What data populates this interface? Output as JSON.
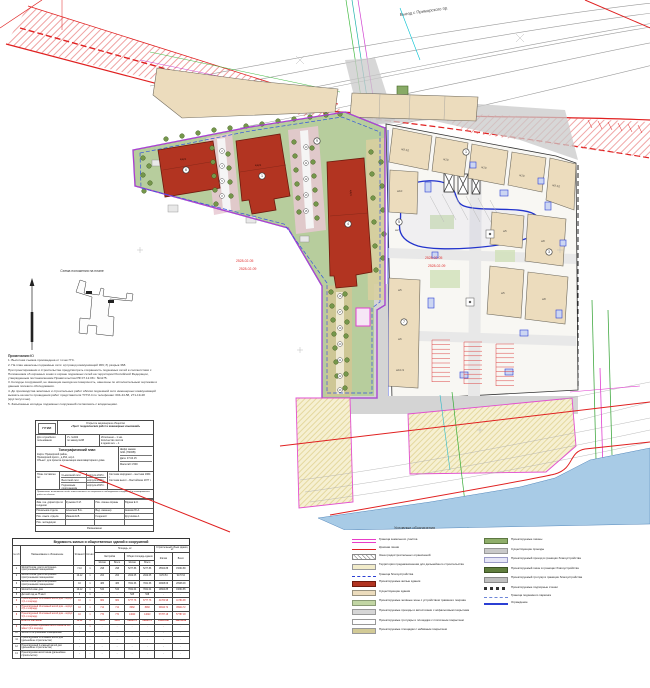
{
  "map": {
    "street_label": "Выезд с Приморского пр.",
    "date1": "2528-02-05",
    "date2": "2528-02-09",
    "lb_a": "жд21",
    "lb_b": "жд21",
    "lb_c": "жд21",
    "rb": [
      "ж9-10",
      "ж10",
      "ж10",
      "ж10",
      "ж9-10",
      "ж10",
      "ж2",
      "ж5",
      "ж8",
      "ж5",
      "ж8",
      "ж5",
      "ж6",
      "ж10-9"
    ],
    "big_circles": [
      "6",
      "1",
      "9",
      "4",
      "1",
      "5",
      "3",
      "7"
    ],
    "spine": [
      "2",
      "3",
      "5",
      "8",
      "10",
      "11",
      "12",
      "13",
      "15",
      "16",
      "17",
      "19",
      "20",
      "21",
      "22",
      "23"
    ],
    "scheme_caption": "Схема положения на плане",
    "north_label": "Ю"
  },
  "notes": {
    "title": "Примечания:",
    "items": [
      "1. Высотная съемка произведена от точек ГГС.",
      "2. На план нанесены подземные сети:  а) провод коммуникаций 369;  б) разрыв 368.",
      "При проектировании и строительстве предусмотреть сохранность подземных сетей в соответствии с Положением об охранных зонах и охране подземных сетей на территории Российской Федерации, утвержденным постановлением Правительства РФ 07.12.08 г. №1175.",
      "3. Колодцы сооружений, не имеющие выхода на поверхность, нанесены по исполнительным чертежам и данным полевого обследования.",
      "4. До производства земляных и строительных работ вблизи подземной сети инженерных коммуникаций вызвать на место проведения работ представителя ТУГИ-4 по телефонам: 004-44-58, 271-19-48 (круглосуточно).",
      "5. Засыпанные колодцы подземных сооружений согласовать с владельцами."
    ]
  },
  "titleblock": {
    "logo": "ГРИИ",
    "org_type": "Открытое акционерное общество",
    "org_name": "«Трест геодезических работ и инженерных изысканий»",
    "dsp": "Для служебного пользования",
    "order_no": "Уч. №402",
    "order_sub": "по заказу №88",
    "copies1": "Исполнено – 1 экз.",
    "copies2": "Количество листов",
    "copies3": "в одном экз. – 1",
    "doc_type": "Топографический план",
    "map_line1": "Карта: Приморский район,",
    "map_line2": "Приморский просп., д.454, кор.1",
    "object_line": "Объект: для проекта организации многоквартирного дома",
    "cipher_label": "Шифр заказа:",
    "cipher": "№91 (Н200В)",
    "date": "Дата: 07.04.15",
    "scale": "Масштаб 1:500",
    "composed_label": "План составлен по:",
    "composed_rows": [
      [
        "Съемочной сети",
        "корпуса 2015 г."
      ],
      [
        "Высотной сети",
        "корпуса 2015 г."
      ],
      [
        "Подземным сооружениям",
        "корпуса 2015 г."
      ]
    ],
    "coord_sys": "Система координат – местная 1964 г.",
    "height_sys": "Система высот – Балтийская 1977 г.",
    "note": "Примечание: исполнитель несёт ответственность за сохранность наблюдаемых сооружений и планировочных работ на объекте.",
    "signatures": [
      [
        "Зам. ген. директора по геодезии",
        "Кузьмин О.И.",
        "Нач. смены охраны",
        "Юдина Е.З."
      ],
      [
        "Начальник отдела",
        "Алексеев В.А.",
        "Вед. инженер",
        "Акимов Ю.А."
      ],
      [
        "Нач. изыск. отдела",
        "Иванов Е.В.",
        "Геодезист",
        "Крутикова А."
      ],
      [
        "Нач. экспедиции",
        "",
        "",
        ""
      ]
    ],
    "footer": "Размножено"
  },
  "table": {
    "title": "Ведомость жилых и общественных зданий и сооружений",
    "h": {
      "num": "№ п/п",
      "name": "Наименование и обозначение",
      "floors": "Этажность",
      "count": "Кол-во",
      "area": "Площадь, м²",
      "built": "Застройки",
      "total": "Общая площадь здания",
      "vol": "Строительный объем здания, м³",
      "lived": "Жилая",
      "all": "Всего"
    },
    "rows": [
      {
        "red": false,
        "bold": false,
        "c": [
          "1",
          "Жилой 9-этаж. дом со встроенно-пристроенными помещениями",
          "7-10",
          "1",
          "298",
          "298",
          "5277.86",
          "5277.86",
          "15664.88",
          "15664.88"
        ]
      },
      {
        "red": false,
        "bold": false,
        "c": [
          "2",
          "Жилой 9-этаж. дом со встроенно-пристроенными помещениями",
          "10-12",
          "1",
          "264",
          "264",
          "2022.05",
          "2022.05",
          "9170.54",
          "9170.54"
        ]
      },
      {
        "red": false,
        "bold": false,
        "c": [
          "3",
          "Жилой 9-этаж. дом со встроенно-пристроенными помещениями",
          "10",
          "1",
          "486",
          "486",
          "7841.66",
          "7841.66",
          "20908.09",
          "20908.09"
        ]
      },
      {
        "red": false,
        "bold": false,
        "c": [
          "4",
          "Жилой 12-этаж. дом",
          "10-12",
          "1",
          "543",
          "543",
          "7841.04",
          "7841.04",
          "19664.85",
          "19664.85"
        ]
      },
      {
        "red": false,
        "bold": false,
        "c": [
          "5",
          "Детский сад на 75 мест",
          "3",
          "1",
          "-",
          "-",
          "528",
          "528",
          "-",
          "-"
        ]
      },
      {
        "red": true,
        "bold": false,
        "c": [
          "6",
          "Проектируемый 10-этажный жилой дом – корпус 1 (1-я очередь)",
          "10",
          "1",
          "982",
          "982",
          "6777.76",
          "6777.76",
          "41784.98",
          "41784.98"
        ]
      },
      {
        "red": true,
        "bold": false,
        "c": [
          "7",
          "Проектируемый 10-этажный жилой дом – корпус 2 (1-я очередь)",
          "10",
          "1",
          "712",
          "712",
          "8082",
          "8082",
          "39944.72",
          "39944.72"
        ]
      },
      {
        "red": true,
        "bold": false,
        "c": [
          "8",
          "Проектируемый 10-этажный жилой дом – корпус 3 (1-я очередь)",
          "10",
          "1",
          "770",
          "770",
          "14623",
          "14623",
          "57787.18",
          "57787.18"
        ]
      },
      {
        "red": true,
        "bold": true,
        "c": [
          "",
          "Итого в том числе",
          "10-12",
          "3",
          "2464",
          "2464",
          "29482.76",
          "29482.76",
          "139516.88",
          "139516.88"
        ]
      },
      {
        "red": true,
        "bold": false,
        "c": [
          "9",
          "Проектируемая подземная автостоянка на 200 м/мест (2-я очередь)",
          "-",
          "1",
          "-",
          "-",
          "-",
          "-",
          "-",
          "-"
        ]
      },
      {
        "red": false,
        "bold": false,
        "c": [
          "10",
          "Жилой со встроенными помещениями",
          "-",
          "-",
          "-",
          "-",
          "-",
          "-",
          "-",
          "-"
        ]
      },
      {
        "red": false,
        "bold": false,
        "c": [
          "11",
          "Проектируемый 25-этажный жилой дом (дальнейшее строительство)",
          "-",
          "-",
          "-",
          "-",
          "-",
          "-",
          "-",
          "-"
        ]
      },
      {
        "red": false,
        "bold": false,
        "c": [
          "12",
          "Проектируемый 2-этажный жилой дом (дальнейшее строительство)",
          "-",
          "-",
          "-",
          "-",
          "-",
          "-",
          "-",
          "-"
        ]
      },
      {
        "red": false,
        "bold": false,
        "c": [
          "13",
          "Проектируемая автостоянка (дальнейшее строительство)",
          "-",
          "-",
          "-",
          "-",
          "-",
          "-",
          "-",
          "-"
        ]
      }
    ]
  },
  "legend": {
    "title": "Условные обозначения",
    "left": [
      {
        "sw": "magenta2",
        "label": "Граница земельного участка"
      },
      {
        "sw": "redline",
        "label": "Красная линия"
      },
      {
        "sw": "hatch",
        "label": "Зона градостроительных ограничений"
      },
      {
        "sw": "paleyellow",
        "label": "Территория предназначенная для дальнейшего строительства"
      },
      {
        "sw": "bluedash",
        "label": "Граница благоустройства"
      },
      {
        "sw": "red",
        "label": "Проектируемые жилые здания"
      },
      {
        "sw": "beige",
        "label": "Существующие здания"
      },
      {
        "sw": "lgreen",
        "label": "Проектируемые зелёные зоны с устройством травяного покрова"
      },
      {
        "sw": "gray",
        "label": "Проектируемые проезды и автостоянки с асфальтовым покрытием"
      },
      {
        "sw": "white",
        "label": "Проектируемые тротуары и площадки с плиточным покрытием"
      },
      {
        "sw": "tan",
        "label": "Проектируемые площадки с набивным покрытием"
      }
    ],
    "right": [
      {
        "sw": "green",
        "label": "Проектируемые газоны"
      },
      {
        "sw": "gray2",
        "label": "Существующие проезды"
      },
      {
        "sw": "lav",
        "label": "Проектируемый проезд в границах благоустройства"
      },
      {
        "sw": "dgreen",
        "label": "Проектируемый газон в границах благоустройства"
      },
      {
        "sw": "gray3",
        "label": "Проектируемый тротуар в границах благоустройства"
      },
      {
        "sw": "dashsq",
        "label": "Проектируемые подпорные стенки"
      },
      {
        "sw": "bluedashdot",
        "label": "Граница подземного паркинга"
      },
      {
        "sw": "blue2",
        "label": "Ограждение"
      }
    ]
  }
}
